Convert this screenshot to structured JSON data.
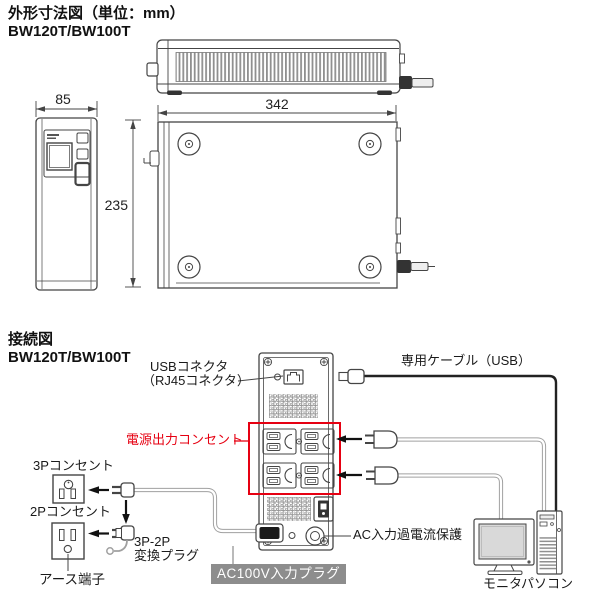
{
  "colors": {
    "line": "#454545",
    "accent_red": "#e60012",
    "label_bg_gray": "#8d8d8d",
    "label_text_white": "#ffffff"
  },
  "dimension_section": {
    "title": "外形寸法図（単位：mm）",
    "model": "BW120T/BW100T",
    "width_mm": "342",
    "front_width_mm": "85",
    "depth_mm": "235"
  },
  "connection_section": {
    "title": "接続図",
    "model": "BW120T/BW100T",
    "usb_connector_line1": "USBコネクタ",
    "usb_connector_line2": "（RJ45コネクタ）",
    "dedicated_cable_label": "専用ケーブル（USB）",
    "power_outlet_label": "電源出力コンセント",
    "outlet_3p_label": "3Pコンセント",
    "outlet_2p_label": "2Pコンセント",
    "adapter_line1": "3P-2P",
    "adapter_line2": "変換プラグ",
    "earth_label": "アース端子",
    "ac_input_label": "AC100V入力プラグ",
    "overcurrent_label": "AC入力過電流保護",
    "monitor_label": "モニタ",
    "pc_label": "パソコン"
  }
}
